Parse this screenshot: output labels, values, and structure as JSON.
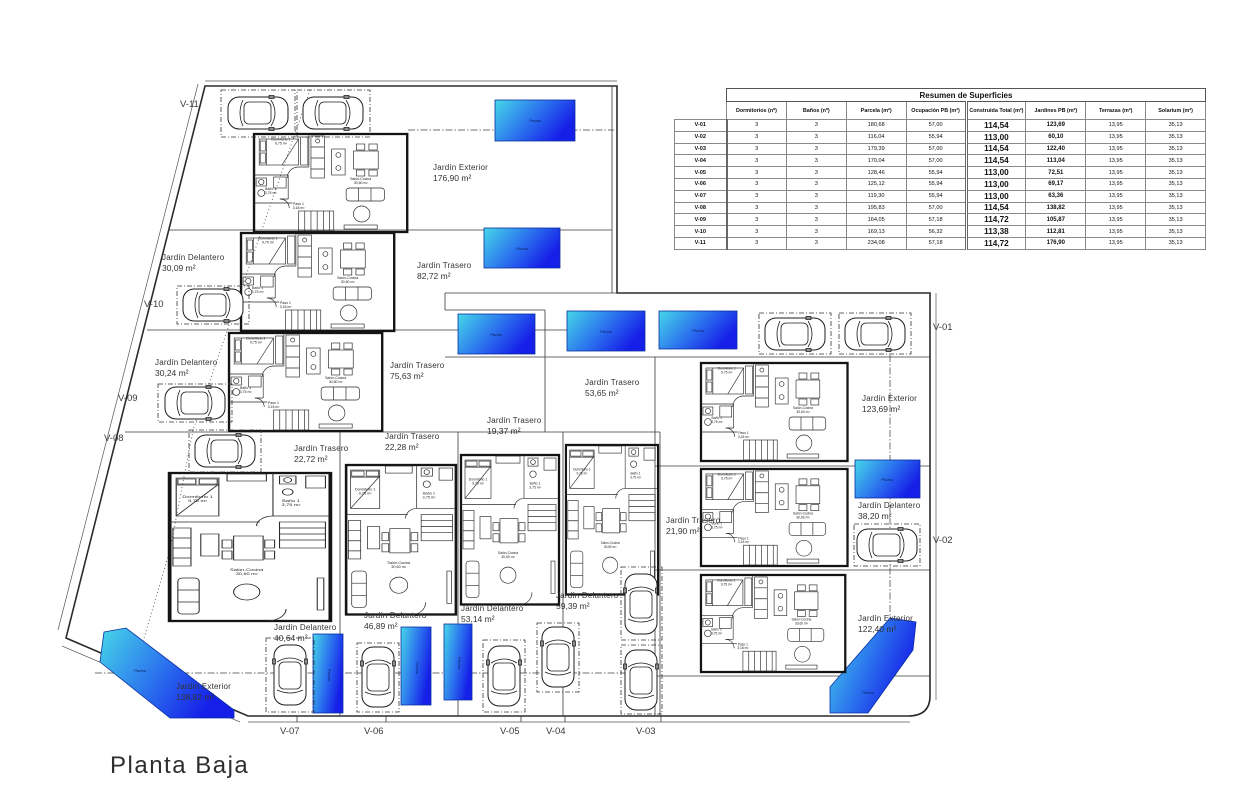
{
  "title": "Planta Baja",
  "table": {
    "title": "Resumen de Superficies",
    "columns": [
      "Dormitorios (nº)",
      "Baños (nº)",
      "Parcela (m²)",
      "Ocupación PB (m²)",
      "Construida Total (m²)",
      "Jardines PB (m²)",
      "Terrazas (m²)",
      "Solarium (m²)"
    ],
    "rows": [
      {
        "id": "V-01",
        "dorm": "3",
        "banos": "3",
        "parcela": "180,68",
        "ocupacion": "57,00",
        "construida": "114,54",
        "jardines": "123,69",
        "terrazas": "13,95",
        "solarium": "35,13"
      },
      {
        "id": "V-02",
        "dorm": "3",
        "banos": "3",
        "parcela": "116,04",
        "ocupacion": "55,94",
        "construida": "113,00",
        "jardines": "60,10",
        "terrazas": "13,95",
        "solarium": "35,13"
      },
      {
        "id": "V-03",
        "dorm": "3",
        "banos": "3",
        "parcela": "179,39",
        "ocupacion": "57,00",
        "construida": "114,54",
        "jardines": "122,40",
        "terrazas": "13,95",
        "solarium": "35,13"
      },
      {
        "id": "V-04",
        "dorm": "3",
        "banos": "3",
        "parcela": "170,04",
        "ocupacion": "57,00",
        "construida": "114,54",
        "jardines": "113,04",
        "terrazas": "13,95",
        "solarium": "35,13"
      },
      {
        "id": "V-05",
        "dorm": "3",
        "banos": "3",
        "parcela": "128,46",
        "ocupacion": "55,94",
        "construida": "113,00",
        "jardines": "72,51",
        "terrazas": "13,95",
        "solarium": "35,13"
      },
      {
        "id": "V-06",
        "dorm": "3",
        "banos": "3",
        "parcela": "125,12",
        "ocupacion": "55,94",
        "construida": "113,00",
        "jardines": "69,17",
        "terrazas": "13,95",
        "solarium": "35,13"
      },
      {
        "id": "V-07",
        "dorm": "3",
        "banos": "3",
        "parcela": "119,30",
        "ocupacion": "55,94",
        "construida": "113,00",
        "jardines": "63,36",
        "terrazas": "13,95",
        "solarium": "35,13"
      },
      {
        "id": "V-08",
        "dorm": "3",
        "banos": "3",
        "parcela": "195,83",
        "ocupacion": "57,00",
        "construida": "114,54",
        "jardines": "138,82",
        "terrazas": "13,95",
        "solarium": "35,13"
      },
      {
        "id": "V-09",
        "dorm": "3",
        "banos": "3",
        "parcela": "164,05",
        "ocupacion": "57,18",
        "construida": "114,72",
        "jardines": "105,87",
        "terrazas": "13,95",
        "solarium": "35,13"
      },
      {
        "id": "V-10",
        "dorm": "3",
        "banos": "3",
        "parcela": "169,13",
        "ocupacion": "56,32",
        "construida": "113,38",
        "jardines": "112,81",
        "terrazas": "13,95",
        "solarium": "35,13"
      },
      {
        "id": "V-11",
        "dorm": "3",
        "banos": "3",
        "parcela": "234,08",
        "ocupacion": "57,18",
        "construida": "114,72",
        "jardines": "176,90",
        "terrazas": "13,95",
        "solarium": "35,13"
      }
    ]
  },
  "plan": {
    "pool_label": "Piscina",
    "rooms": {
      "dormitorio": "Dormitorio 1",
      "dormitorio_area": "9,75 m²",
      "bano": "Baño 1",
      "bano_area": "3,75 m²",
      "paso": "Paso 1",
      "paso_area": "3,18 m²",
      "salon": "Salón-Cocina",
      "salon_area": "30,60 m²"
    },
    "units": [
      "V-11",
      "V-10",
      "V-09",
      "V-08",
      "V-01",
      "V-02",
      "V-07",
      "V-06",
      "V-05",
      "V-04",
      "V-03"
    ],
    "gardens": [
      {
        "name": "Jardín Exterior",
        "area": "176,90 m²"
      },
      {
        "name": "Jardín Delantero",
        "area": "30,09 m²"
      },
      {
        "name": "Jardín Trasero",
        "area": "82,72 m²"
      },
      {
        "name": "Jardín Delantero",
        "area": "30,24 m²"
      },
      {
        "name": "Jardín Trasero",
        "area": "75,63 m²"
      },
      {
        "name": "Jardín Trasero",
        "area": "53,65 m²"
      },
      {
        "name": "Jardín Exterior",
        "area": "123,69 m²"
      },
      {
        "name": "Jardín Trasero",
        "area": "19,37 m²"
      },
      {
        "name": "Jardín Trasero",
        "area": "22,28 m²"
      },
      {
        "name": "Jardín Trasero",
        "area": "22,72 m²"
      },
      {
        "name": "Jardín Trasero",
        "area": "21,90 m²"
      },
      {
        "name": "Jardín Delantero",
        "area": "38,20 m²"
      },
      {
        "name": "Jardín Exterior",
        "area": "122,40 m²"
      },
      {
        "name": "Jardín Exterior",
        "area": "138,82 m²"
      },
      {
        "name": "Jardín Delantero",
        "area": "40,64 m²"
      },
      {
        "name": "Jardín Delantero",
        "area": "46,89 m²"
      },
      {
        "name": "Jardín Delantero",
        "area": "53,14 m²"
      },
      {
        "name": "Jardín Delantero",
        "area": "59,39 m²"
      }
    ]
  }
}
